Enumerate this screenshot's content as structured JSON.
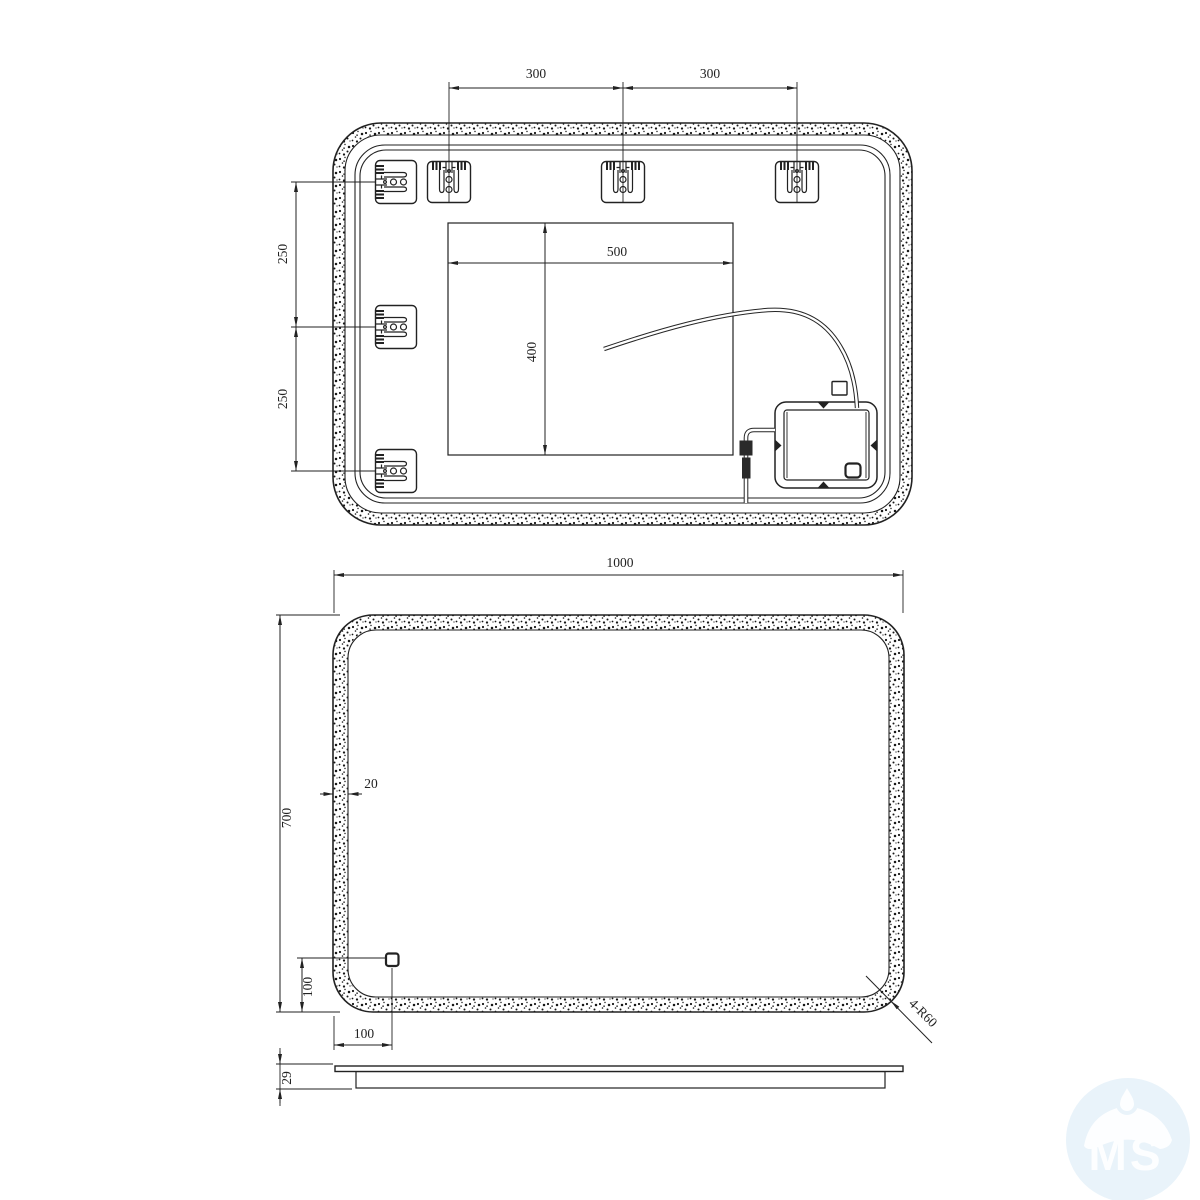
{
  "drawing": {
    "top_view": {
      "dim_bracket_spacing_left": "300",
      "dim_bracket_spacing_right": "300",
      "dim_side_spacing_upper": "250",
      "dim_side_spacing_lower": "250",
      "dim_cutout_width": "500",
      "dim_cutout_height": "400"
    },
    "front_view": {
      "dim_width": "1000",
      "dim_height": "700",
      "dim_frame_thickness": "20",
      "dim_sensor_from_left": "100",
      "dim_sensor_from_bottom": "100",
      "dim_corner_radius": "4-R60"
    },
    "side_view": {
      "dim_depth": "29"
    },
    "watermark": {
      "text": "MS"
    },
    "colors": {
      "line": "#2a2a2a",
      "watermark_bg": "#e9f3fa",
      "watermark_fg": "#fdfeff"
    }
  }
}
